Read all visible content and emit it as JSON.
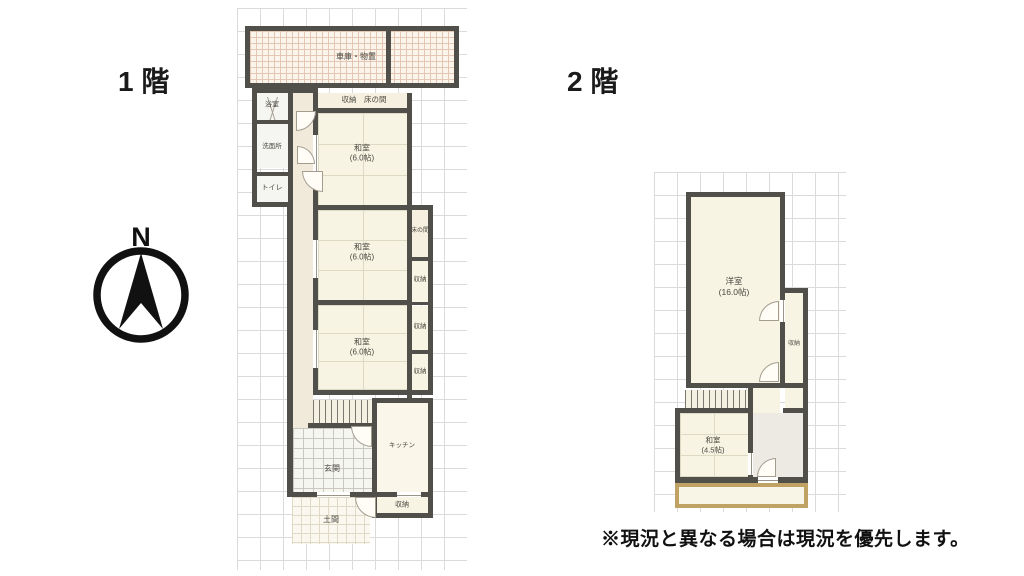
{
  "titles": {
    "floor1": "1 階",
    "floor2": "2 階"
  },
  "note": "※現況と異なる場合は現況を優先します。",
  "compass": {
    "label": "N"
  },
  "colors": {
    "wall": "#514f4a",
    "balcony_border": "#c0a265",
    "grid": "#dbdbdb",
    "room_fill": "#f8f4e4"
  },
  "floor1": {
    "garage": "車庫・物置",
    "bath": "浴室",
    "washroom": "洗面所",
    "toilet": "トイレ",
    "storage_tokonoma": "収納　床の間",
    "room1_name": "和室",
    "room1_size": "(6.0帖)",
    "room2_name": "和室",
    "room2_size": "(6.0帖)",
    "room3_name": "和室",
    "room3_size": "(6.0帖)",
    "tokonoma": "床の間",
    "closet1": "収納",
    "closet2": "収納",
    "closet3": "収納",
    "kitchen": "キッチン",
    "kitchen_storage": "収納",
    "entrance": "玄関",
    "doma": "土間"
  },
  "floor2": {
    "western_name": "洋室",
    "western_size": "(16.0帖)",
    "closet": "収納",
    "japanese_name": "和室",
    "japanese_size": "(4.5帖)"
  }
}
